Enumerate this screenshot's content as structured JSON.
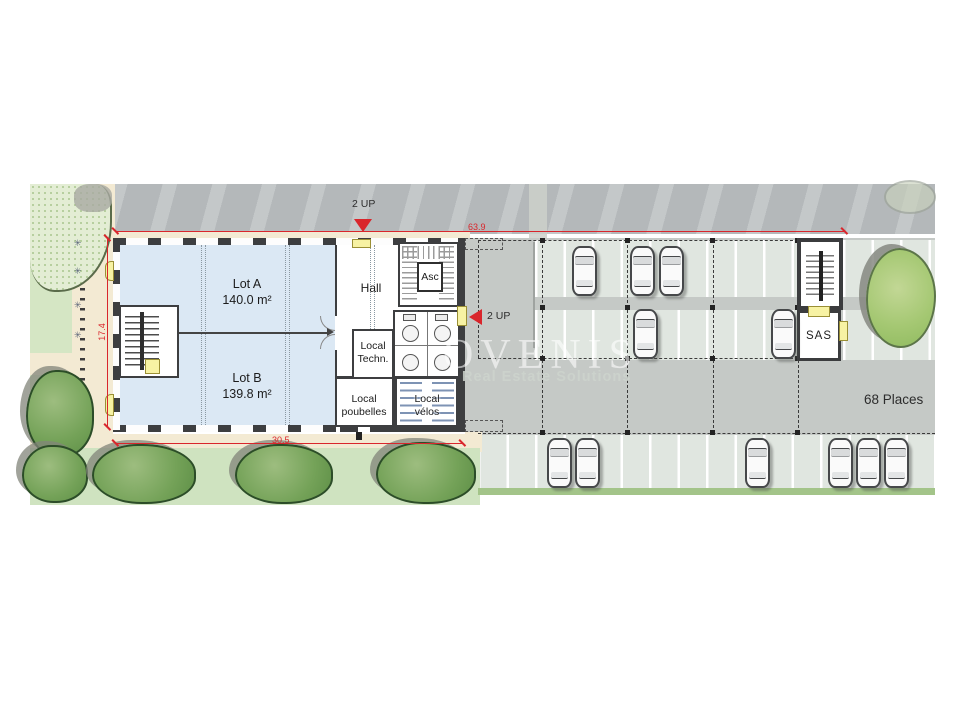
{
  "watermark": {
    "brand": "OVENIS",
    "tagline": "Real Estate Solutions"
  },
  "markers": {
    "up_top": "2 UP",
    "up_right": "2 UP"
  },
  "dimensions": {
    "total_width": "63.9",
    "depth": "17.4",
    "building_width": "30.5"
  },
  "rooms": {
    "lot_a": "Lot A\n140.0 m²",
    "lot_b": "Lot B\n139.8 m²",
    "hall": "Hall",
    "elevator": "Asc",
    "tech": "Local\nTechn.",
    "bins": "Local\npoubelles",
    "bikes": "Local\nvélos",
    "sas": "SAS"
  },
  "parking": {
    "capacity": "68 Places",
    "cars": [
      {
        "x": 572,
        "y": 246
      },
      {
        "x": 630,
        "y": 246
      },
      {
        "x": 659,
        "y": 246
      },
      {
        "x": 633,
        "y": 309
      },
      {
        "x": 771,
        "y": 309
      },
      {
        "x": 547,
        "y": 438
      },
      {
        "x": 575,
        "y": 438
      },
      {
        "x": 745,
        "y": 438
      },
      {
        "x": 828,
        "y": 438
      },
      {
        "x": 856,
        "y": 438
      },
      {
        "x": 884,
        "y": 438
      }
    ]
  },
  "colors": {
    "dimension_red": "#d9262c",
    "lot_blue": "#dbe8f4",
    "wall_dark": "#3d3e40",
    "stall_green": "#e0e6e0",
    "lawn_green": "#cfe3c0",
    "door_yellow": "#f7f2a3"
  }
}
